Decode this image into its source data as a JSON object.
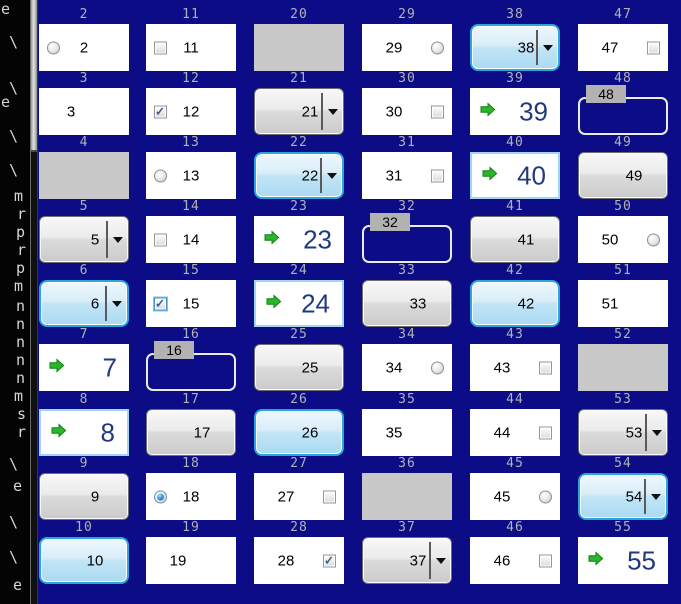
{
  "colors": {
    "panel_background": "#0c0c87",
    "focus_border": "#2aa5dd",
    "focus_fill_top": "#eef8fd",
    "focus_fill_bottom": "#a9daf2",
    "arrow_green": "#2cb42c",
    "label_gray": "#b2b2b5",
    "disabled_gray": "#c8c8c8",
    "big_number_blue": "#22397f",
    "button_gray_top": "#f8f8f8",
    "button_gray_bottom": "#cbcbcb",
    "check_mark_color": "#3d5a80"
  },
  "icons": {
    "dropdown_arrow": "▼",
    "check_mark": "✓",
    "green_arrow": "right-arrow",
    "radio_dot": "●"
  },
  "terminal": {
    "chars": [
      {
        "ch": "e",
        "x": 1,
        "y": 1
      },
      {
        "ch": "\\",
        "x": 9,
        "y": 34
      },
      {
        "ch": "\\",
        "x": 9,
        "y": 80
      },
      {
        "ch": "e",
        "x": 1,
        "y": 94
      },
      {
        "ch": "\\",
        "x": 9,
        "y": 128
      },
      {
        "ch": "\\",
        "x": 9,
        "y": 162
      },
      {
        "ch": "m",
        "x": 14,
        "y": 188
      },
      {
        "ch": "r",
        "x": 17,
        "y": 206
      },
      {
        "ch": "p",
        "x": 16,
        "y": 224
      },
      {
        "ch": "r",
        "x": 17,
        "y": 242
      },
      {
        "ch": "p",
        "x": 16,
        "y": 260
      },
      {
        "ch": "m",
        "x": 14,
        "y": 278
      },
      {
        "ch": "n",
        "x": 16,
        "y": 298
      },
      {
        "ch": "n",
        "x": 16,
        "y": 316
      },
      {
        "ch": "n",
        "x": 16,
        "y": 334
      },
      {
        "ch": "n",
        "x": 16,
        "y": 352
      },
      {
        "ch": "n",
        "x": 16,
        "y": 370
      },
      {
        "ch": "m",
        "x": 14,
        "y": 388
      },
      {
        "ch": "s",
        "x": 17,
        "y": 406
      },
      {
        "ch": "r",
        "x": 17,
        "y": 424
      },
      {
        "ch": "\\",
        "x": 9,
        "y": 456
      },
      {
        "ch": "e",
        "x": 13,
        "y": 478
      },
      {
        "ch": "\\",
        "x": 9,
        "y": 514
      },
      {
        "ch": "\\",
        "x": 9,
        "y": 549
      },
      {
        "ch": "e",
        "x": 13,
        "y": 577
      }
    ]
  },
  "cells": [
    {
      "n": 2,
      "type": "radio",
      "side": "left",
      "checked": false
    },
    {
      "n": 3,
      "type": "plain"
    },
    {
      "n": 4,
      "type": "gray"
    },
    {
      "n": 5,
      "type": "combo"
    },
    {
      "n": 6,
      "type": "combo",
      "focus": true
    },
    {
      "n": 7,
      "type": "arrow"
    },
    {
      "n": 8,
      "type": "arrow",
      "focus": true
    },
    {
      "n": 9,
      "type": "button"
    },
    {
      "n": 10,
      "type": "button",
      "focus": true
    },
    {
      "n": 11,
      "type": "check",
      "side": "left",
      "checked": false
    },
    {
      "n": 12,
      "type": "check",
      "side": "left",
      "checked": true
    },
    {
      "n": 13,
      "type": "radio",
      "side": "left",
      "checked": false
    },
    {
      "n": 14,
      "type": "check",
      "side": "left",
      "checked": false
    },
    {
      "n": 15,
      "type": "check",
      "side": "left",
      "checked": true,
      "focus": true
    },
    {
      "n": 16,
      "type": "group"
    },
    {
      "n": 17,
      "type": "button"
    },
    {
      "n": 18,
      "type": "radio",
      "side": "left",
      "checked": true
    },
    {
      "n": 19,
      "type": "plain"
    },
    {
      "n": 20,
      "type": "gray"
    },
    {
      "n": 21,
      "type": "combo"
    },
    {
      "n": 22,
      "type": "combo",
      "focus": true
    },
    {
      "n": 23,
      "type": "arrow"
    },
    {
      "n": 24,
      "type": "arrow",
      "focus": true
    },
    {
      "n": 25,
      "type": "button"
    },
    {
      "n": 26,
      "type": "button",
      "focus": true
    },
    {
      "n": 27,
      "type": "check",
      "side": "right",
      "checked": false
    },
    {
      "n": 28,
      "type": "check",
      "side": "right",
      "checked": true
    },
    {
      "n": 29,
      "type": "radio",
      "side": "right",
      "checked": false
    },
    {
      "n": 30,
      "type": "check",
      "side": "right",
      "checked": false
    },
    {
      "n": 31,
      "type": "check",
      "side": "right",
      "checked": false
    },
    {
      "n": 32,
      "type": "group"
    },
    {
      "n": 33,
      "type": "button"
    },
    {
      "n": 34,
      "type": "radio",
      "side": "right",
      "checked": false
    },
    {
      "n": 35,
      "type": "plain"
    },
    {
      "n": 36,
      "type": "gray"
    },
    {
      "n": 37,
      "type": "combo"
    },
    {
      "n": 38,
      "type": "combo",
      "focus": true
    },
    {
      "n": 39,
      "type": "arrow"
    },
    {
      "n": 40,
      "type": "arrow",
      "focus": true
    },
    {
      "n": 41,
      "type": "button"
    },
    {
      "n": 42,
      "type": "button",
      "focus": true
    },
    {
      "n": 43,
      "type": "check",
      "side": "right",
      "checked": false
    },
    {
      "n": 44,
      "type": "check",
      "side": "right",
      "checked": false
    },
    {
      "n": 45,
      "type": "radio",
      "side": "right",
      "checked": false
    },
    {
      "n": 46,
      "type": "check",
      "side": "right",
      "checked": false
    },
    {
      "n": 47,
      "type": "check",
      "side": "right",
      "checked": false
    },
    {
      "n": 48,
      "type": "group"
    },
    {
      "n": 49,
      "type": "button"
    },
    {
      "n": 50,
      "type": "radio",
      "side": "right",
      "checked": false
    },
    {
      "n": 51,
      "type": "plain"
    },
    {
      "n": 52,
      "type": "gray"
    },
    {
      "n": 53,
      "type": "combo"
    },
    {
      "n": 54,
      "type": "combo",
      "focus": true
    },
    {
      "n": 55,
      "type": "arrow"
    }
  ]
}
